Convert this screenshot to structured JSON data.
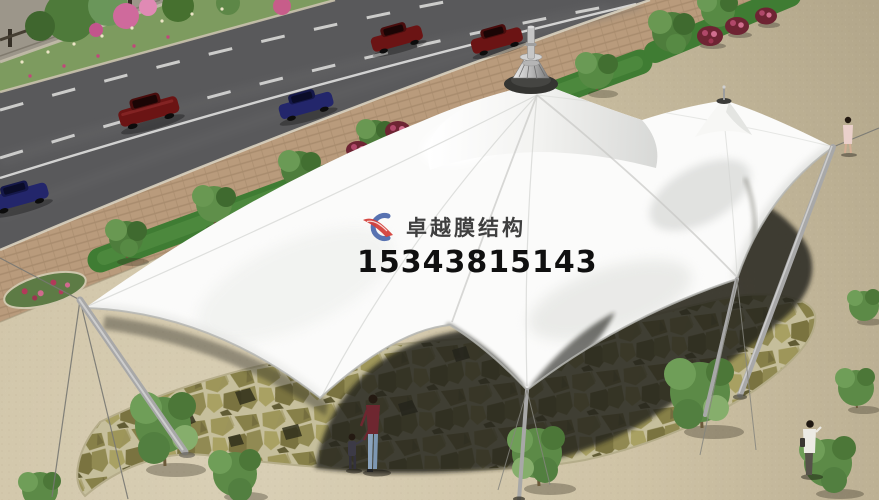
{
  "watermark": {
    "brand": "卓越膜结构",
    "phone": "15343815143",
    "brand_color": "#3f3f3f",
    "phone_color": "#101010",
    "logo_blue": "#4a66aa",
    "logo_red": "#d4403a"
  },
  "scene": {
    "colors": {
      "road": "#59595b",
      "road_marking": "#e8e8e6",
      "sidewalk_brick": "#b99b7c",
      "median_grass": "#7d9b5f",
      "wall": "#9c968a",
      "planter_green": "#3f7c33",
      "tree_green": "#5f8f4a",
      "flower_pink": "#cf6a9c",
      "bush_red": "#6e2433",
      "plaza_sand": "#cfc3a6",
      "flagstone_olive": "#938d52",
      "flagstone_mortar": "#c6bf9c",
      "canopy_shadow": "#24231a",
      "membrane_white": "#fbfbfa",
      "mast_gray": "#a8a8a8",
      "car_red": "#6b1414",
      "car_blue": "#23266b"
    }
  }
}
